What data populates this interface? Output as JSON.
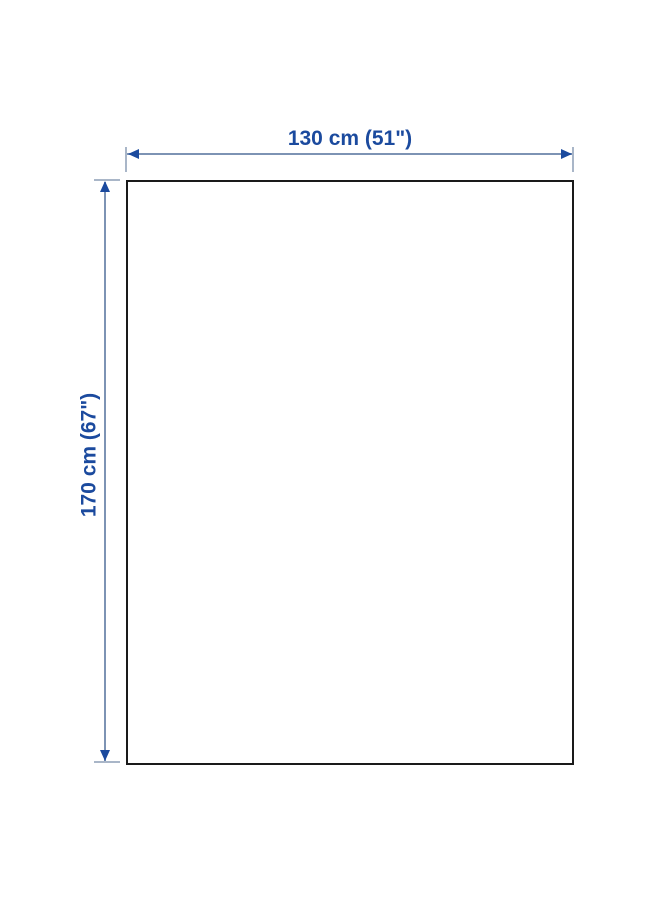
{
  "diagram": {
    "type": "product-dimension-diagram",
    "width_label": "130 cm (51\")",
    "height_label": "170 cm (67\")",
    "colors": {
      "label_text": "#1b4a9e",
      "arrowhead": "#1b4a9e",
      "line": "#7d93b4",
      "tick": "#a9b6c8",
      "outline": "#1a1a1a",
      "background": "#ffffff"
    }
  }
}
